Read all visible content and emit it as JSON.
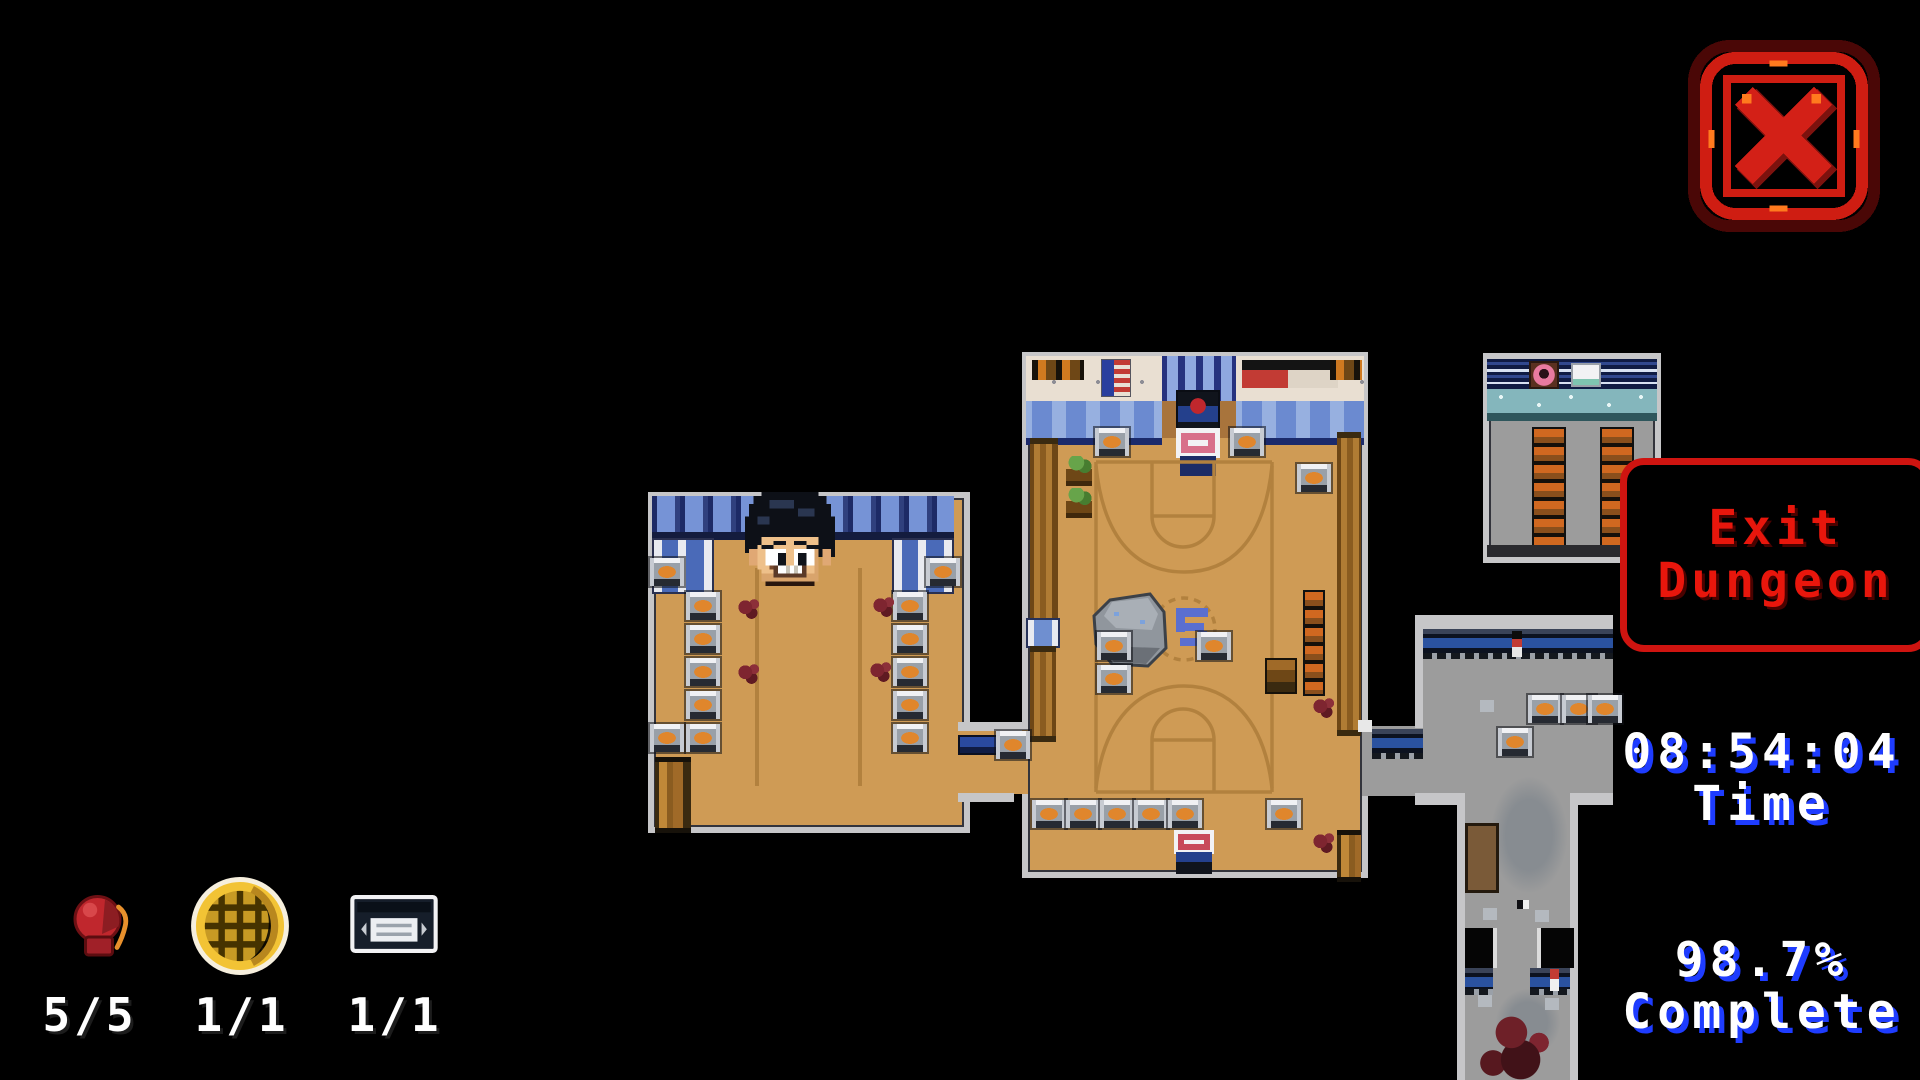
{
  "ui": {
    "close_button": {
      "icon": "close-x-icon"
    },
    "exit_button": {
      "line1": "Exit",
      "line2": "Dungeon"
    },
    "timer": {
      "value": "08:54:04",
      "label": "Time"
    },
    "completion": {
      "value": "98.7%",
      "label": "Complete"
    },
    "collectibles": [
      {
        "icon": "boxing-glove-icon",
        "count": "5/5"
      },
      {
        "icon": "waffle-icon",
        "count": "1/1"
      },
      {
        "icon": "vhs-tape-icon",
        "count": "1/1"
      }
    ]
  },
  "colors": {
    "background": "#000000",
    "accent_red": "#cf1410",
    "exit_text_red": "#e8160c",
    "stat_text": "#ffffff",
    "stat_shadow_blue": "#1e3cff",
    "floor_tan": "#cf9b55",
    "court_line_tan": "#b2813e",
    "corridor_gray": "#9c9c9c",
    "locker_blue": "#7693d6",
    "wall_gray": "#c6c6c8"
  }
}
